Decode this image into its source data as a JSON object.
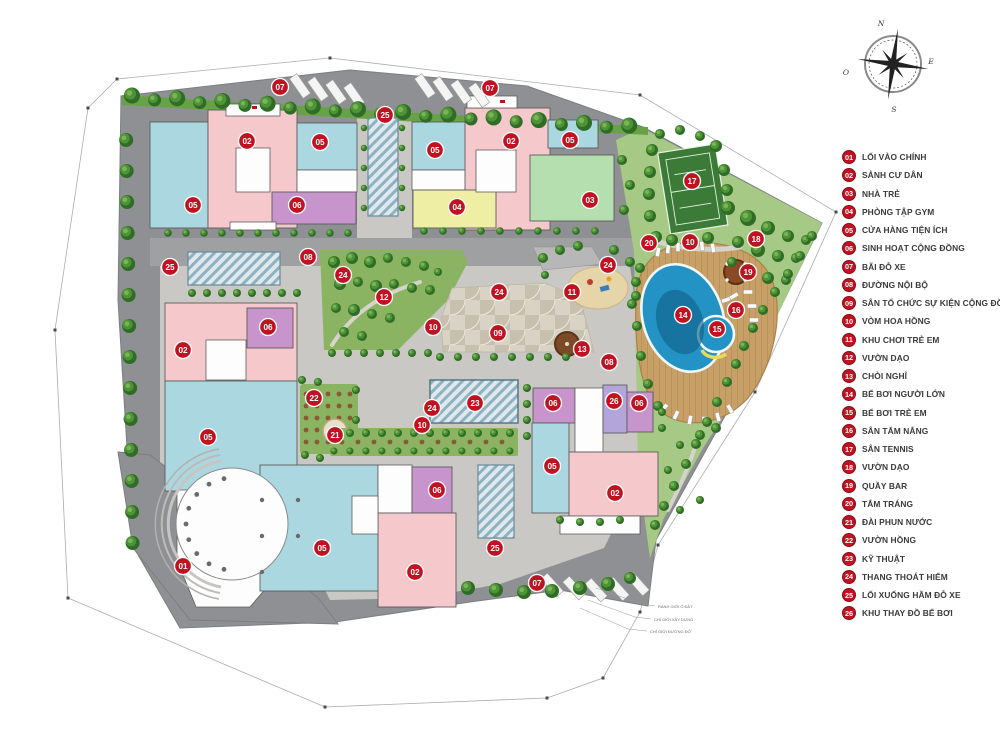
{
  "title": "Mặt bằng tổng thể khu căn hộ",
  "legend": {
    "items": [
      {
        "num": "01",
        "label": "LỐI VÀO CHÍNH"
      },
      {
        "num": "02",
        "label": "SẢNH CƯ DÂN"
      },
      {
        "num": "03",
        "label": "NHÀ TRẺ"
      },
      {
        "num": "04",
        "label": "PHÒNG TẬP GYM"
      },
      {
        "num": "05",
        "label": "CỬA HÀNG TIỆN ÍCH"
      },
      {
        "num": "06",
        "label": "SINH HOẠT CỘNG ĐỒNG"
      },
      {
        "num": "07",
        "label": "BÃI ĐỖ XE"
      },
      {
        "num": "08",
        "label": "ĐƯỜNG NỘI BỘ"
      },
      {
        "num": "09",
        "label": "SÂN TỔ CHỨC SỰ KIỆN CỘNG ĐỒNG"
      },
      {
        "num": "10",
        "label": "VÒM HOA HỒNG"
      },
      {
        "num": "11",
        "label": "KHU CHƠI TRẺ EM"
      },
      {
        "num": "12",
        "label": "VƯỜN DẠO"
      },
      {
        "num": "13",
        "label": "CHÒI NGHỈ"
      },
      {
        "num": "14",
        "label": "BỂ BƠI NGƯỜI LỚN"
      },
      {
        "num": "15",
        "label": "BỂ BƠI TRẺ EM"
      },
      {
        "num": "16",
        "label": "SÂN TẮM NẮNG"
      },
      {
        "num": "17",
        "label": "SÂN TENNIS"
      },
      {
        "num": "18",
        "label": "VƯỜN DẠO"
      },
      {
        "num": "19",
        "label": "QUẦY BAR"
      },
      {
        "num": "20",
        "label": "TẮM TRÁNG"
      },
      {
        "num": "21",
        "label": "ĐÀI PHUN NƯỚC"
      },
      {
        "num": "22",
        "label": "VƯỜN HỒNG"
      },
      {
        "num": "23",
        "label": "KỸ THUẬT"
      },
      {
        "num": "24",
        "label": "THANG THOÁT HIỂM"
      },
      {
        "num": "25",
        "label": "LỐI XUỐNG HẦM ĐỖ XE"
      },
      {
        "num": "26",
        "label": "KHU THAY ĐỒ BỂ BƠI"
      }
    ]
  },
  "compass": {
    "north": "N",
    "east": "E",
    "south": "S",
    "west": "O"
  },
  "markers": [
    {
      "n": "07",
      "x": 280,
      "y": 87
    },
    {
      "n": "07",
      "x": 490,
      "y": 88
    },
    {
      "n": "07",
      "x": 537,
      "y": 583
    },
    {
      "n": "25",
      "x": 385,
      "y": 115
    },
    {
      "n": "25",
      "x": 170,
      "y": 267
    },
    {
      "n": "25",
      "x": 495,
      "y": 548
    },
    {
      "n": "02",
      "x": 247,
      "y": 141
    },
    {
      "n": "02",
      "x": 511,
      "y": 141
    },
    {
      "n": "02",
      "x": 183,
      "y": 350
    },
    {
      "n": "02",
      "x": 415,
      "y": 572
    },
    {
      "n": "02",
      "x": 615,
      "y": 493
    },
    {
      "n": "05",
      "x": 193,
      "y": 205
    },
    {
      "n": "05",
      "x": 320,
      "y": 142
    },
    {
      "n": "05",
      "x": 435,
      "y": 150
    },
    {
      "n": "05",
      "x": 570,
      "y": 140
    },
    {
      "n": "05",
      "x": 208,
      "y": 437
    },
    {
      "n": "05",
      "x": 322,
      "y": 548
    },
    {
      "n": "05",
      "x": 552,
      "y": 466
    },
    {
      "n": "06",
      "x": 297,
      "y": 205
    },
    {
      "n": "06",
      "x": 268,
      "y": 327
    },
    {
      "n": "06",
      "x": 437,
      "y": 490
    },
    {
      "n": "06",
      "x": 553,
      "y": 403
    },
    {
      "n": "06",
      "x": 639,
      "y": 403
    },
    {
      "n": "04",
      "x": 457,
      "y": 207
    },
    {
      "n": "03",
      "x": 590,
      "y": 200
    },
    {
      "n": "01",
      "x": 183,
      "y": 566
    },
    {
      "n": "08",
      "x": 308,
      "y": 257
    },
    {
      "n": "08",
      "x": 609,
      "y": 362
    },
    {
      "n": "12",
      "x": 384,
      "y": 297
    },
    {
      "n": "10",
      "x": 433,
      "y": 327
    },
    {
      "n": "10",
      "x": 422,
      "y": 425
    },
    {
      "n": "10",
      "x": 690,
      "y": 242
    },
    {
      "n": "24",
      "x": 343,
      "y": 275
    },
    {
      "n": "24",
      "x": 499,
      "y": 292
    },
    {
      "n": "24",
      "x": 608,
      "y": 265
    },
    {
      "n": "24",
      "x": 432,
      "y": 408
    },
    {
      "n": "11",
      "x": 572,
      "y": 292
    },
    {
      "n": "09",
      "x": 498,
      "y": 333
    },
    {
      "n": "13",
      "x": 582,
      "y": 349
    },
    {
      "n": "22",
      "x": 314,
      "y": 398
    },
    {
      "n": "21",
      "x": 335,
      "y": 435
    },
    {
      "n": "23",
      "x": 475,
      "y": 403
    },
    {
      "n": "17",
      "x": 692,
      "y": 181
    },
    {
      "n": "18",
      "x": 756,
      "y": 239
    },
    {
      "n": "19",
      "x": 748,
      "y": 272
    },
    {
      "n": "20",
      "x": 649,
      "y": 243
    },
    {
      "n": "14",
      "x": 683,
      "y": 315
    },
    {
      "n": "15",
      "x": 717,
      "y": 329
    },
    {
      "n": "16",
      "x": 736,
      "y": 310
    },
    {
      "n": "26",
      "x": 614,
      "y": 401
    }
  ],
  "annotations": [
    {
      "text": "RANH GIỚI Ô ĐẤT",
      "x": 658,
      "y": 608
    },
    {
      "text": "CHỈ GIỚI XÂY DỰNG",
      "x": 654,
      "y": 621
    },
    {
      "text": "CHỈ GIỚI ĐƯỜNG ĐỎ",
      "x": 650,
      "y": 633
    }
  ],
  "colors": {
    "marker": "#bf1322",
    "legend_text": "#3a3a3a",
    "survey": "#a9adb0",
    "road": "#8e9093",
    "plaza": "#c9c8c4",
    "plaza_band": "#b4b4b5",
    "lawn": "#a6c985",
    "lawn_dark": "#8ab461",
    "hedge": "#67a246",
    "tree_dark": "#2f6d26",
    "tree_mid": "#4f9338",
    "tree_light": "#79b457",
    "deck": "#c7a067",
    "deck_line": "#b3854d",
    "water": "#2293c4",
    "water_deep": "#13638c",
    "water_rim": "#eef7f9",
    "tennis_green": "#3b7a37",
    "sand": "#e6d5a9",
    "b_pink": "#f5c8cc",
    "b_blue": "#abd7e1",
    "b_purple": "#c794cb",
    "b_yellow": "#eeefa5",
    "b_green": "#b6dfb0",
    "b_violet": "#b3a5da",
    "b_white": "#fdfdfd",
    "b_wall": "#5d5d5d",
    "hatch_a": "#dfe9ed",
    "hatch_b": "#8fb2c2",
    "plaza09_a": "#d9d3c5",
    "plaza09_b": "#c7c0ae",
    "gazebo": "#7c4a27",
    "bar": "#8a4a26"
  }
}
